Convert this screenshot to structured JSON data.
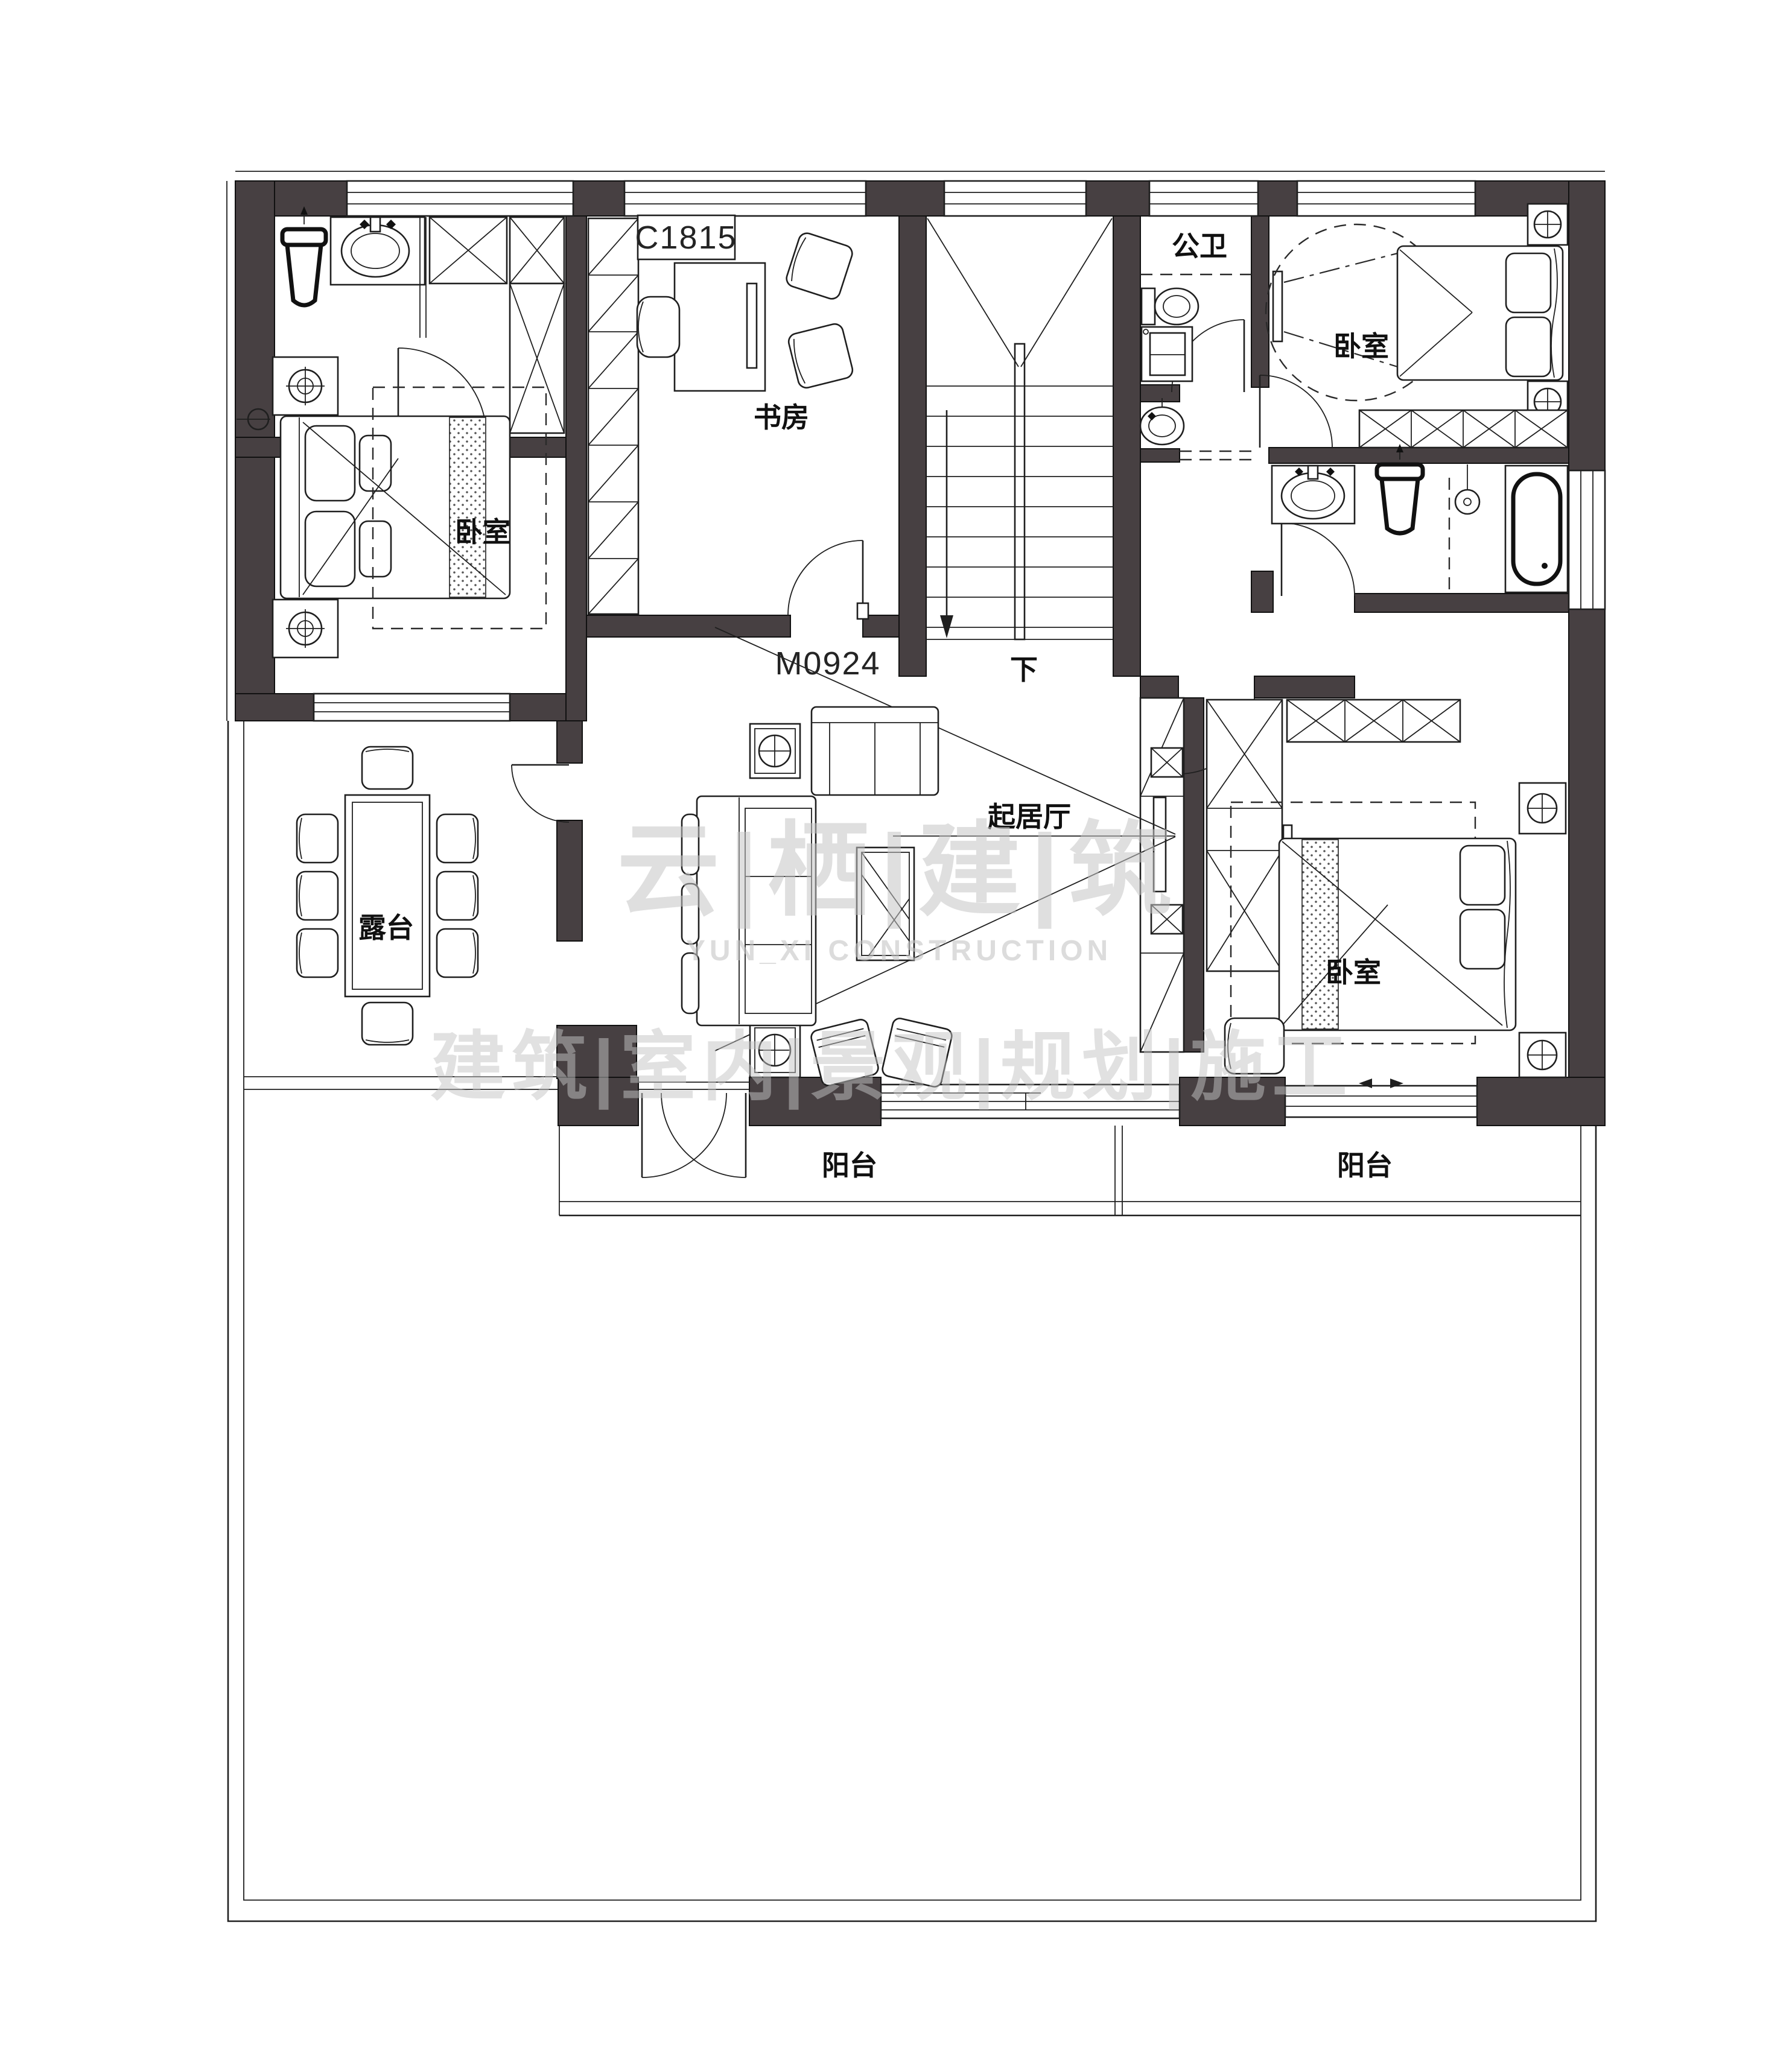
{
  "colors": {
    "wall": "#474042",
    "line": "#1f1f1f",
    "watermark": "#c5c5c5"
  },
  "labels": {
    "bedroom_left": "卧室",
    "bedroom_top_right": "卧室",
    "bedroom_bottom_right": "卧室",
    "study": "书房",
    "guest_bath": "公卫",
    "living_room": "起居厅",
    "terrace": "露台",
    "balcony_left": "阳台",
    "balcony_right": "阳台",
    "stairs_down": "下",
    "window_code": "C1815",
    "door_code": "M0924"
  },
  "watermarks": {
    "brand_cn": "云|栖|建|筑",
    "brand_en": "YUN_XI CONSTRUCTION",
    "services": "建筑|室内|景观|规划|施工"
  }
}
